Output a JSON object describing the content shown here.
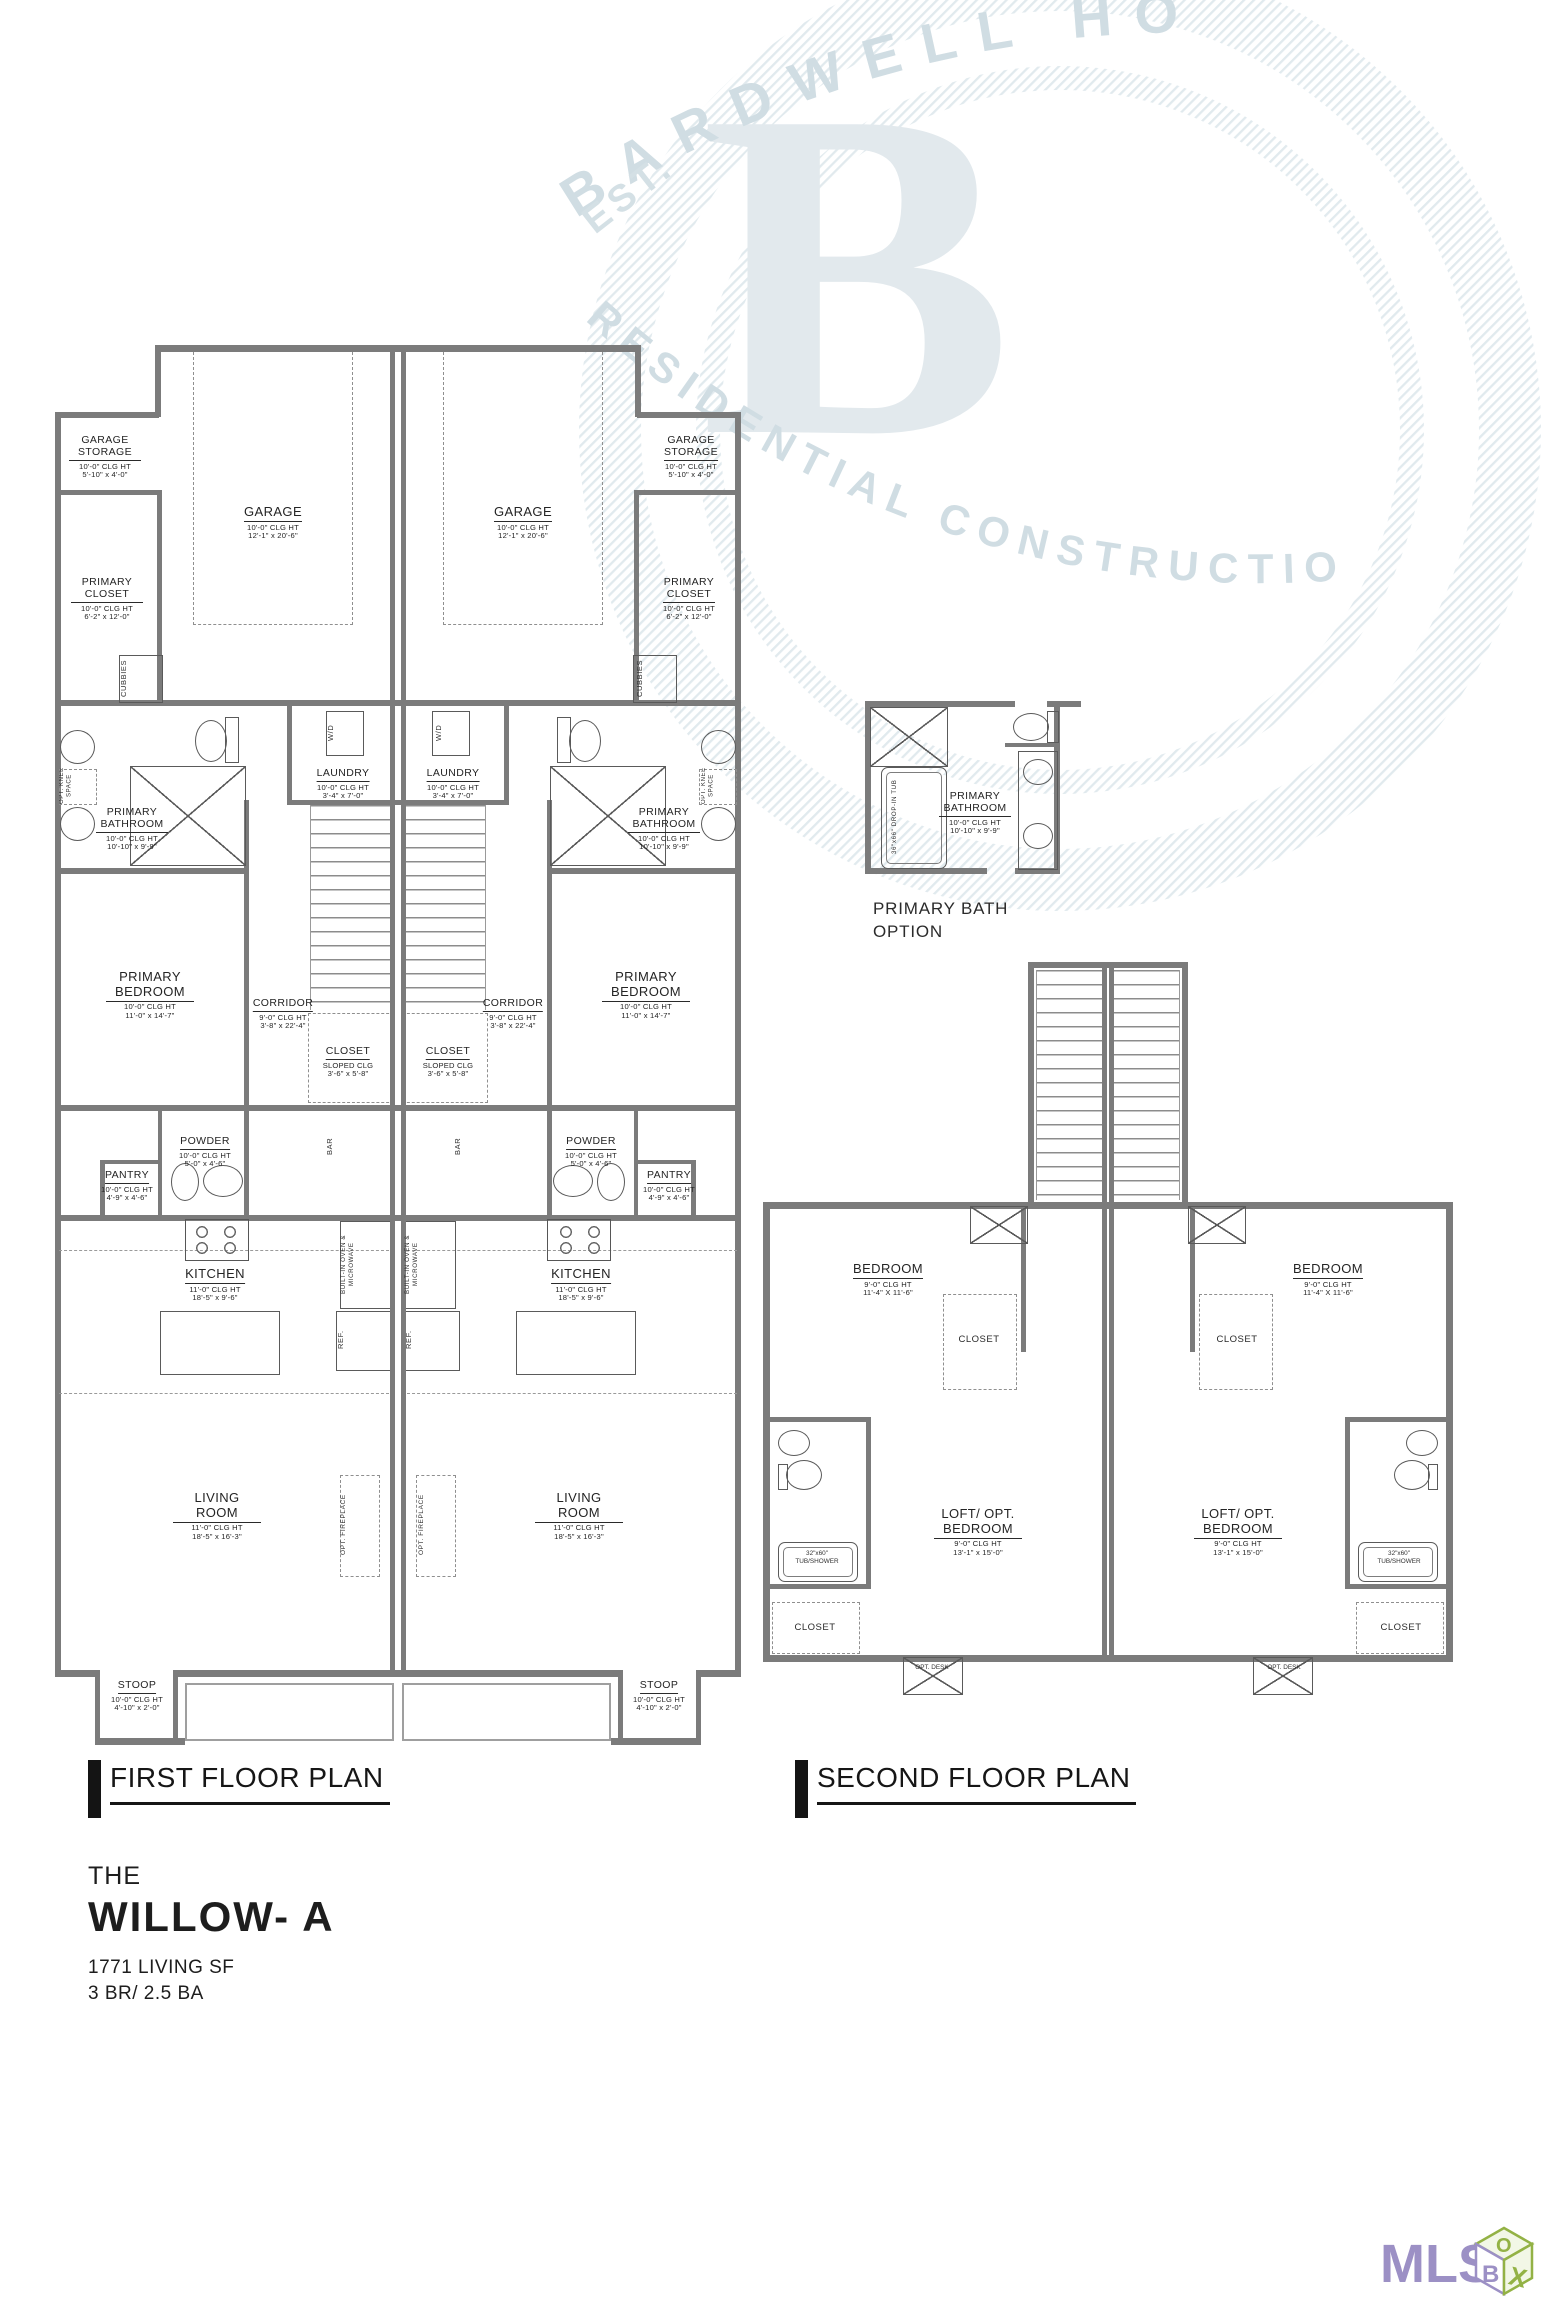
{
  "watermark": {
    "arc_top": "BARDWELL HO",
    "est": "EST.",
    "arc_bottom": "RESIDENTIAL  CONSTRUCTIO",
    "big_letter": "B"
  },
  "titles": {
    "first": "FIRST FLOOR PLAN",
    "second": "SECOND FLOOR PLAN"
  },
  "info": {
    "prefix": "THE",
    "name": "WILLOW- A",
    "living_sf": "1771 LIVING SF",
    "bed_bath": "3 BR/ 2.5 BA"
  },
  "first_floor": {
    "rooms": {
      "garage_storage": {
        "name": "GARAGE STORAGE",
        "clg": "10'-0\" CLG HT",
        "dims": "5'-10\" x 4'-0\""
      },
      "garage": {
        "name": "GARAGE",
        "clg": "10'-0\" CLG HT",
        "dims": "12'-1\" x 20'-6\""
      },
      "primary_closet": {
        "name": "PRIMARY CLOSET",
        "clg": "10'-0\" CLG HT",
        "dims": "6'-2\" x 12'-0\""
      },
      "cubbies": {
        "name": "CUBBIES"
      },
      "knee_space": {
        "name": "OPT. KNEE SPACE"
      },
      "primary_bathroom": {
        "name": "PRIMARY BATHROOM",
        "clg": "10'-0\" CLG HT",
        "dims": "10'-10\" x 9'-9\""
      },
      "laundry": {
        "name": "LAUNDRY",
        "clg": "10'-0\" CLG HT",
        "dims": "3'-4\" x 7'-0\""
      },
      "wd": {
        "name": "W/D"
      },
      "primary_bedroom": {
        "name": "PRIMARY BEDROOM",
        "clg": "10'-0\" CLG HT",
        "dims": "11'-0\" x 14'-7\""
      },
      "corridor": {
        "name": "CORRIDOR",
        "clg": "9'-0\" CLG HT",
        "dims": "3'-8\" x 22'-4\""
      },
      "closet": {
        "name": "CLOSET",
        "clg": "SLOPED CLG",
        "dims": "3'-6\" x 5'-8\""
      },
      "powder": {
        "name": "POWDER",
        "clg": "10'-0\" CLG HT",
        "dims": "5'-0\" x 4'-6\""
      },
      "pantry": {
        "name": "PANTRY",
        "clg": "10'-0\" CLG HT",
        "dims": "4'-9\" x 4'-6\""
      },
      "bar": {
        "name": "BAR"
      },
      "kitchen": {
        "name": "KITCHEN",
        "clg": "11'-0\" CLG HT",
        "dims": "18'-5\" x 9'-6\""
      },
      "oven": {
        "name": "BUILT-IN OVEN & MICROWAVE"
      },
      "ref": {
        "name": "REF."
      },
      "living_room": {
        "name": "LIVING ROOM",
        "clg": "11'-0\" CLG HT",
        "dims": "18'-5\" x 16'-3\""
      },
      "fireplace": {
        "name": "OPT. FIREPLACE"
      },
      "stoop": {
        "name": "STOOP",
        "clg": "10'-0\" CLG HT",
        "dims": "4'-10\" x 2'-0\""
      }
    }
  },
  "bath_option": {
    "room": {
      "name": "PRIMARY BATHROOM",
      "clg": "10'-0\" CLG HT",
      "dims": "10'-10\" x 9'-9\""
    },
    "tub": "36\"x66\" DROP-IN TUB",
    "caption": "PRIMARY BATH OPTION"
  },
  "second_floor": {
    "rooms": {
      "bedroom": {
        "name": "BEDROOM",
        "clg": "9'-0\" CLG HT",
        "dims": "11'-4\" X 11'-6\""
      },
      "closet": {
        "name": "CLOSET"
      },
      "loft": {
        "name": "LOFT/ OPT. BEDROOM",
        "clg": "9'-0\" CLG HT",
        "dims": "13'-1\" x 15'-0\""
      },
      "tub_shower": {
        "name": "32\"x60\" TUB/SHOWER"
      },
      "opt_desk": {
        "name": "OPT. DESK"
      }
    }
  },
  "logo": {
    "text": "MLS",
    "top": "O",
    "left": "B",
    "right": "X"
  }
}
